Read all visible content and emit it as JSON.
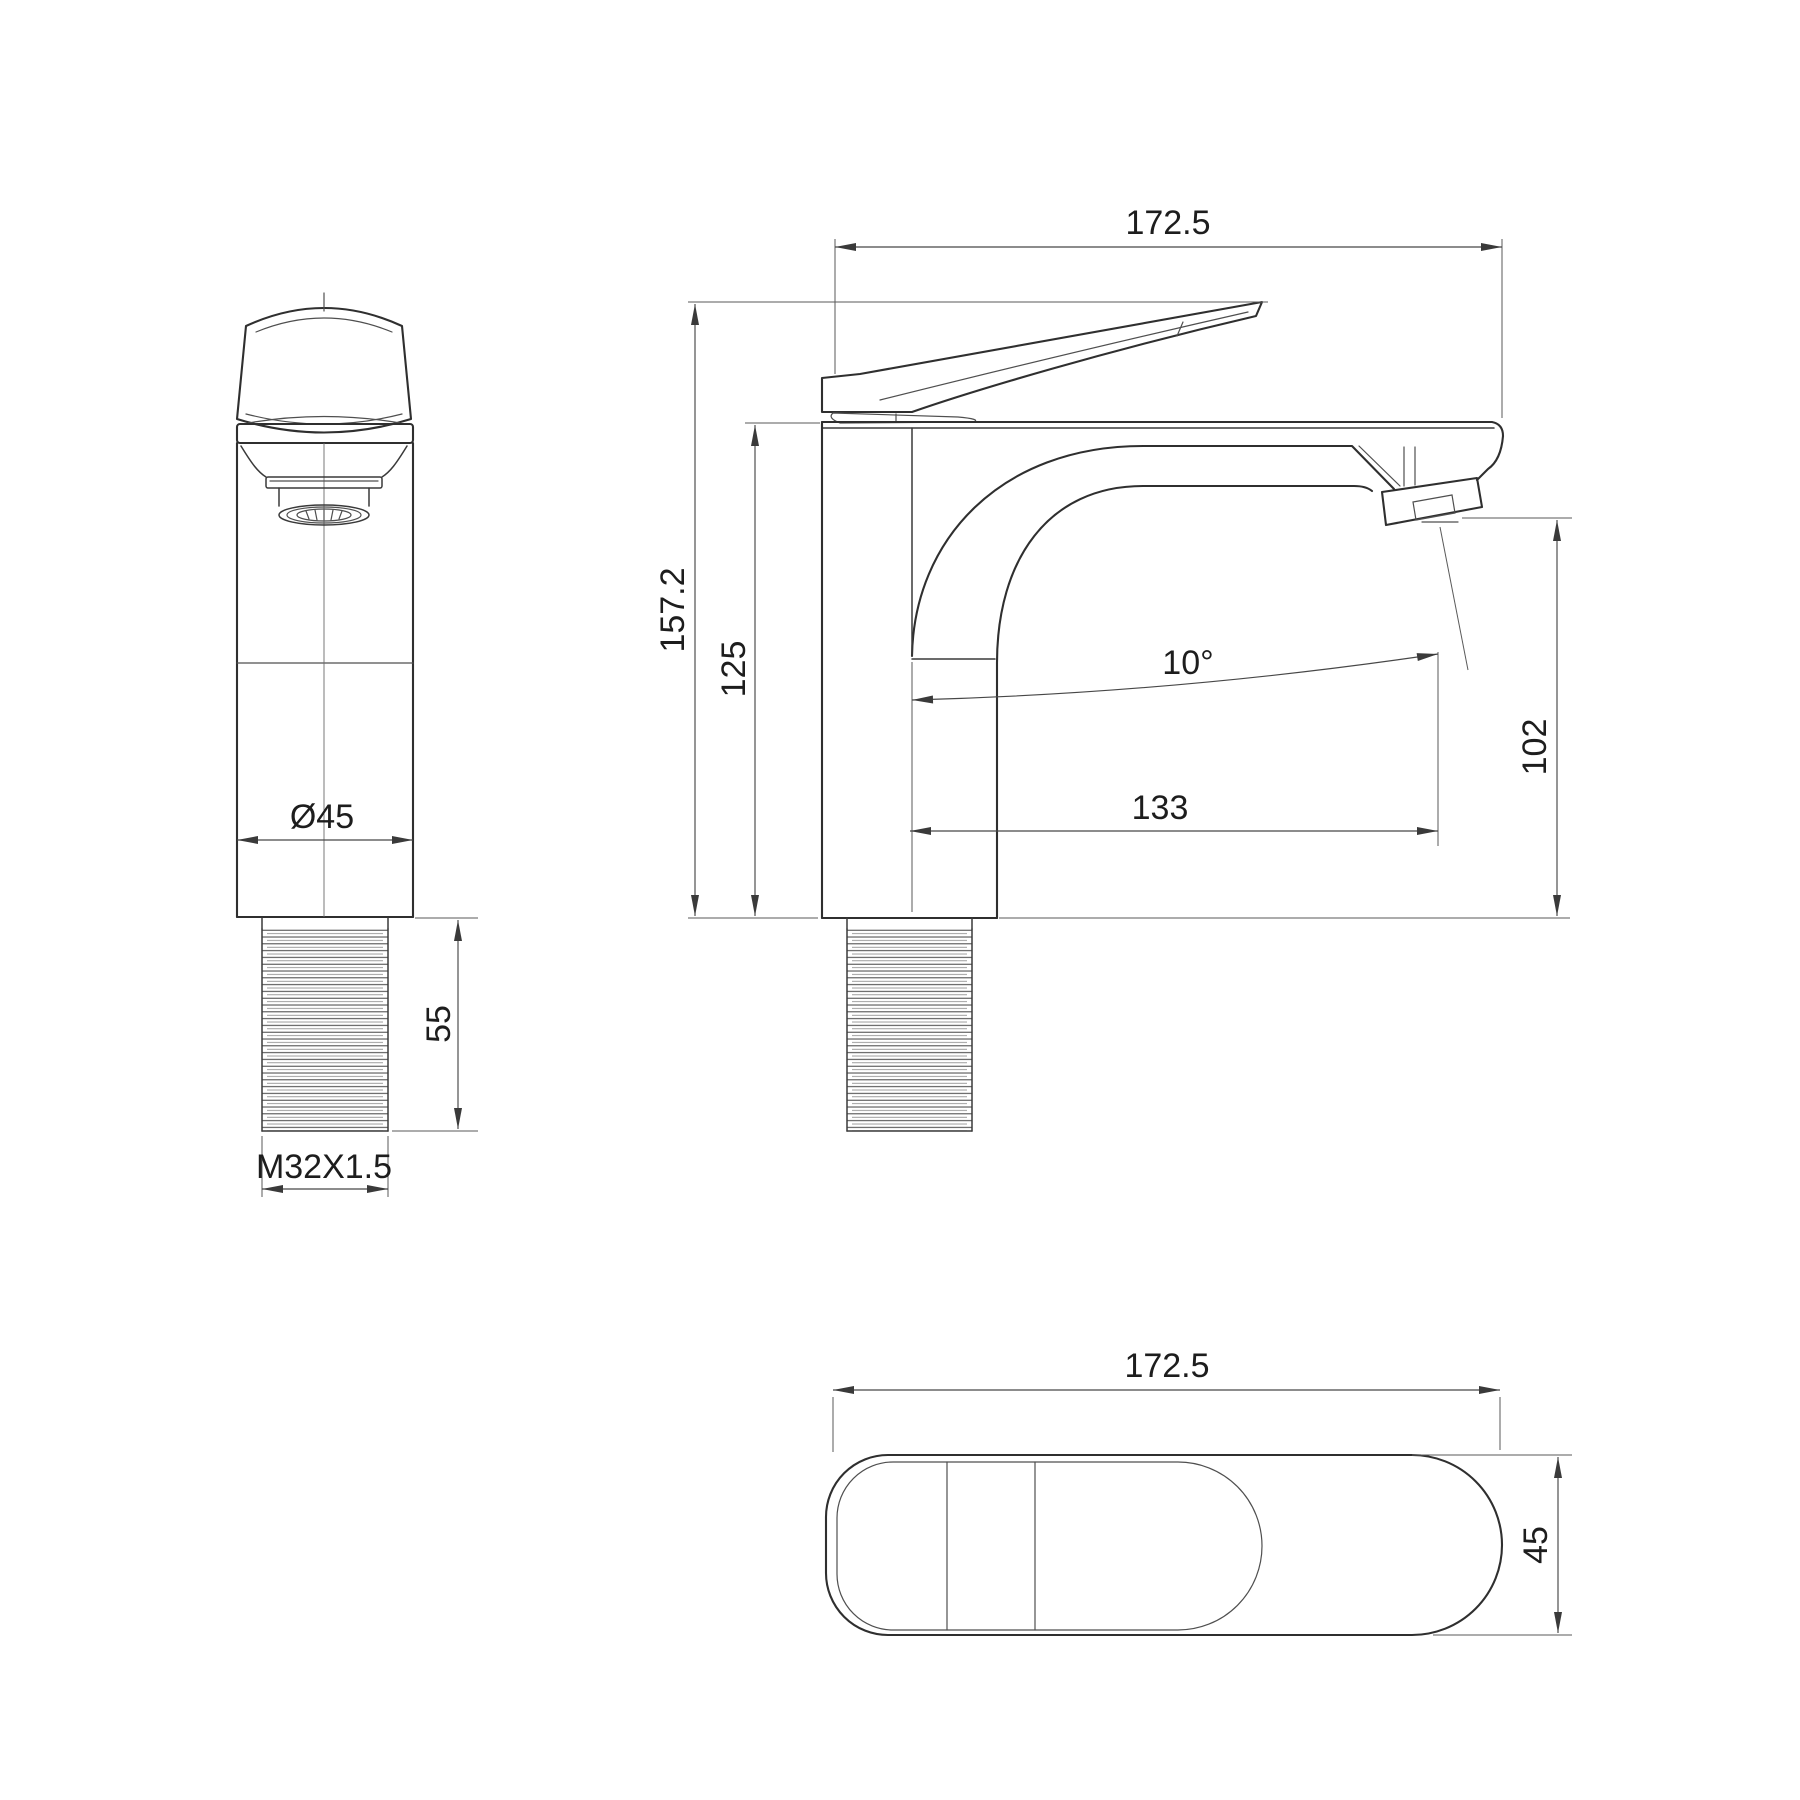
{
  "drawing": {
    "type": "faucet-technical-drawing",
    "colors": {
      "background": "#ffffff",
      "object_line": "#2f2f2f",
      "dimension_line": "#474747",
      "text": "#1d1d1d"
    },
    "views": {
      "front": {
        "dimensions": {
          "body_diameter": "Ø45",
          "shank_length": "55",
          "thread_spec": "M32X1.5"
        }
      },
      "side": {
        "dimensions": {
          "overall_length": "172.5",
          "overall_height": "157.2",
          "body_height": "125",
          "spout_angle": "10°",
          "outlet_height": "102",
          "spout_reach": "133"
        }
      },
      "top": {
        "dimensions": {
          "overall_length": "172.5",
          "body_width": "45"
        }
      }
    }
  }
}
